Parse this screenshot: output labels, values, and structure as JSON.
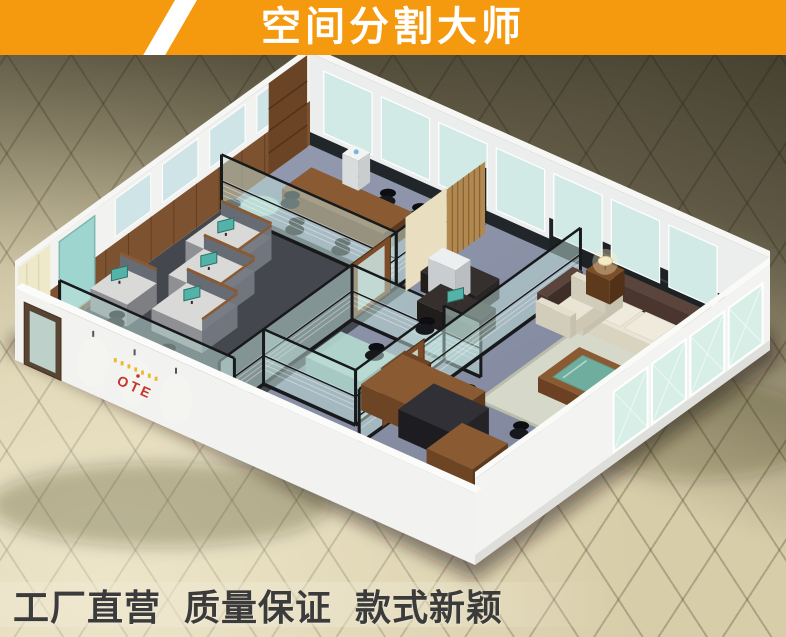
{
  "banner": {
    "title": "空间分割大师",
    "bg_color": "#F5990F",
    "stripe_color": "#FFFFFF",
    "text_color": "#FFFFFF"
  },
  "footer": {
    "slogan": "工厂直营 质量保证 款式新颖",
    "text_color": "#3B3B3B"
  },
  "office": {
    "logo_text": "OTE",
    "logo_color": "#C8352B",
    "logo_accent_color": "#E9B61F",
    "colors": {
      "wall_white": "#F2F2F0",
      "wall_shade": "#ECEDED",
      "carpet_blue": "#8A92AB",
      "carpet_dark": "#45474E",
      "glass_tint": "#C3E4DE",
      "partition_frame": "#17191B",
      "wood_mid": "#8A5A32",
      "wood_dark": "#6B4323",
      "sofa_cream": "#E9E4D3",
      "cushion_brown": "#57413A",
      "glass_table_green": "#6FAE9E",
      "desk_gray": "#D9D9D7",
      "monitor_teal": "#53B3A8",
      "floor_tile_light": "#DCD1AC",
      "floor_tile_dark": "#55503E",
      "marble_black": "#1D2225"
    }
  }
}
